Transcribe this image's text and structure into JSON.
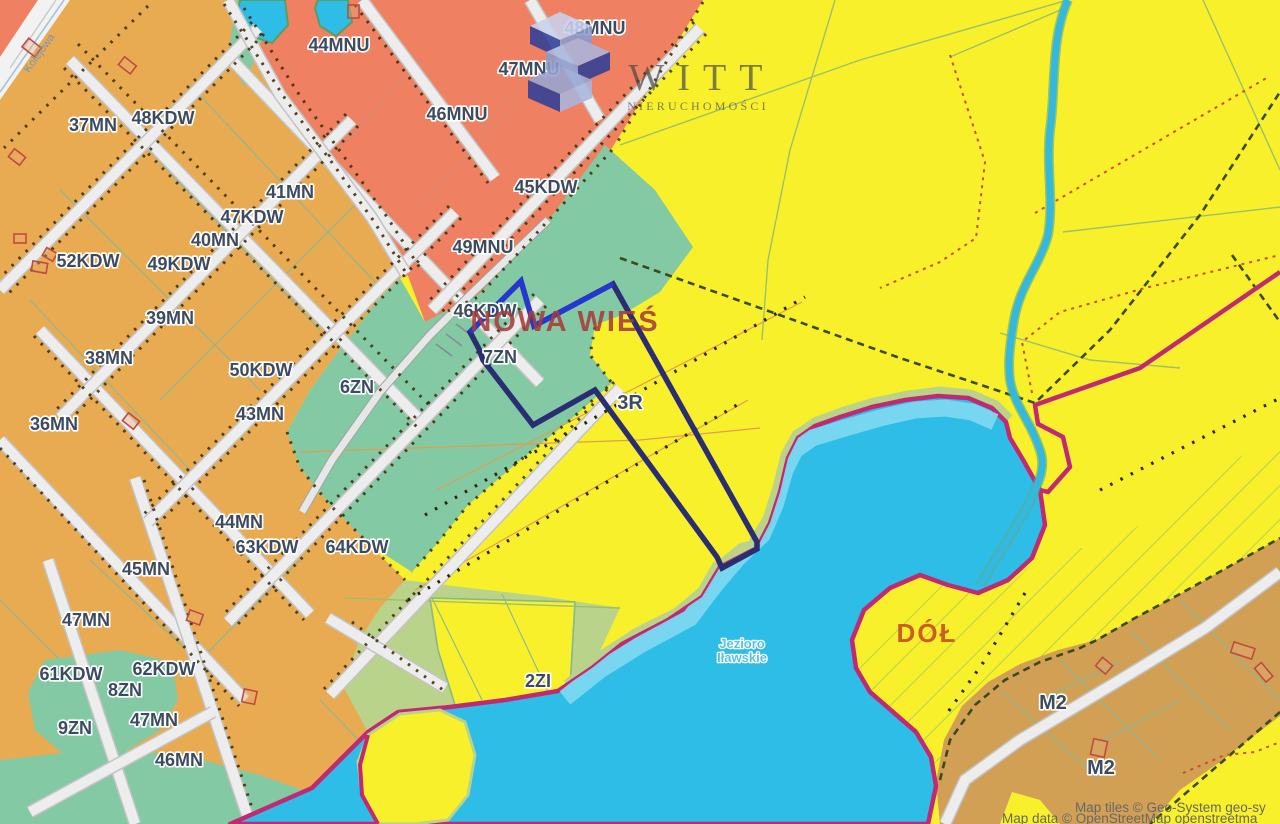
{
  "watermark": {
    "brand": "WITT",
    "subtitle": "NIERUCHOMOŚCI"
  },
  "attribution": {
    "line1": "Map tiles © Geo-System geo-sy",
    "line2": "Map data © OpenStreetMap openstreetma"
  },
  "place_labels": {
    "town": "NOWA WIEŚ",
    "area": "DÓŁ",
    "lake_line1": "Jezioro",
    "lake_line2": "Iławskie",
    "street": "Kolejowa"
  },
  "zone_labels": [
    {
      "id": "37MN",
      "text": "37MN"
    },
    {
      "id": "48KDW",
      "text": "48KDW"
    },
    {
      "id": "41MN",
      "text": "41MN"
    },
    {
      "id": "47KDW",
      "text": "47KDW"
    },
    {
      "id": "40MN",
      "text": "40MN"
    },
    {
      "id": "52KDW",
      "text": "52KDW"
    },
    {
      "id": "49KDW",
      "text": "49KDW"
    },
    {
      "id": "39MN",
      "text": "39MN"
    },
    {
      "id": "38MN",
      "text": "38MN"
    },
    {
      "id": "50KDW",
      "text": "50KDW"
    },
    {
      "id": "43MN",
      "text": "43MN"
    },
    {
      "id": "36MN",
      "text": "36MN"
    },
    {
      "id": "44MN",
      "text": "44MN"
    },
    {
      "id": "63KDW",
      "text": "63KDW"
    },
    {
      "id": "64KDW",
      "text": "64KDW"
    },
    {
      "id": "45MN",
      "text": "45MN"
    },
    {
      "id": "47MN-a",
      "text": "47MN"
    },
    {
      "id": "61KDW",
      "text": "61KDW"
    },
    {
      "id": "62KDW",
      "text": "62KDW"
    },
    {
      "id": "8ZN",
      "text": "8ZN"
    },
    {
      "id": "9ZN",
      "text": "9ZN"
    },
    {
      "id": "47MN-b",
      "text": "47MN"
    },
    {
      "id": "46MN",
      "text": "46MN"
    },
    {
      "id": "44MNU",
      "text": "44MNU"
    },
    {
      "id": "48MNU",
      "text": "48MNU"
    },
    {
      "id": "47MNU",
      "text": "47MNU"
    },
    {
      "id": "46MNU",
      "text": "46MNU"
    },
    {
      "id": "45KDW",
      "text": "45KDW"
    },
    {
      "id": "49MNU",
      "text": "49MNU"
    },
    {
      "id": "46KDW",
      "text": "46KDW"
    },
    {
      "id": "7ZN",
      "text": "7ZN"
    },
    {
      "id": "6ZN",
      "text": "6ZN"
    },
    {
      "id": "3R",
      "text": "3R"
    },
    {
      "id": "2ZI",
      "text": "2ZI"
    },
    {
      "id": "M2-a",
      "text": "M2"
    },
    {
      "id": "M2-b",
      "text": "M2"
    }
  ],
  "colors": {
    "residential_mn": "#e9ab51",
    "residential_mnu": "#ef8162",
    "settlement_m2": "#d2a055",
    "greenery_zn": "#83c9a4",
    "greenery_zi": "#b9d48a",
    "agricultural_r": "#f9f02c",
    "water": "#2ebde6",
    "water_shallow": "#7dd7f1",
    "boundary_magenta": "#c12a72",
    "parcel_highlight_dark": "#2a2d72",
    "parcel_highlight_bright": "#2437d4",
    "road": "#ededed",
    "logo_navy": "#2f3f98",
    "logo_periwinkle": "#aab6dd"
  }
}
